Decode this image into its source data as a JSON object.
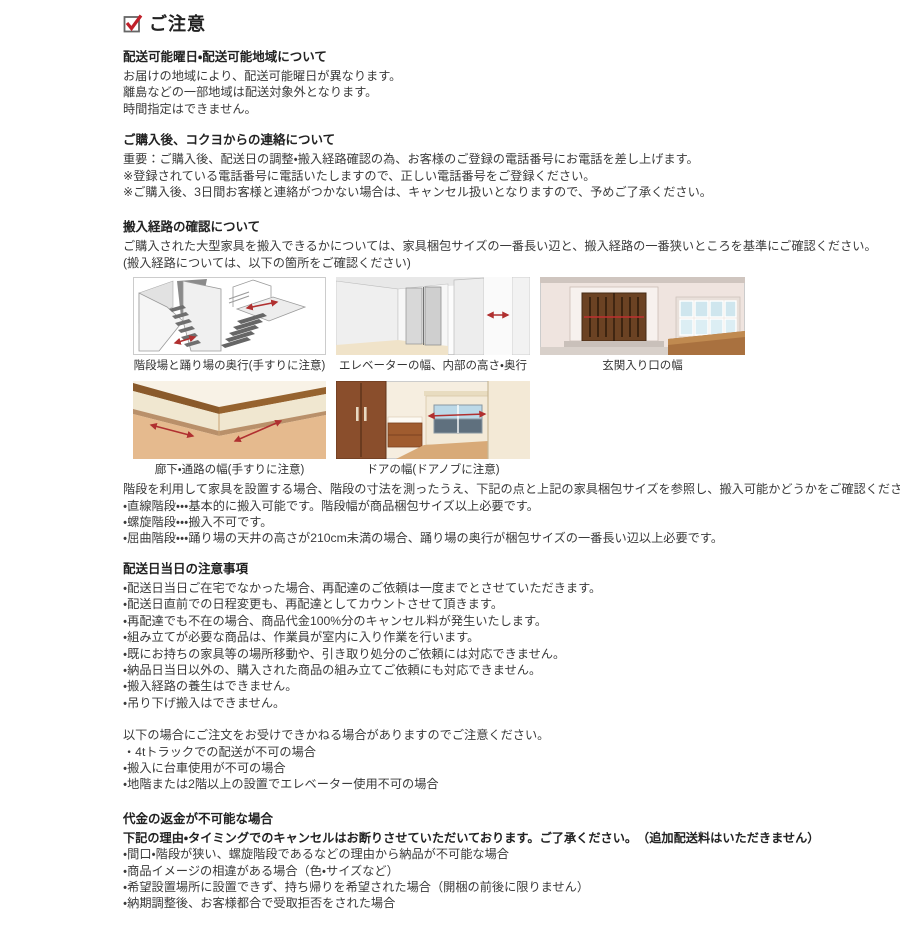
{
  "page": {
    "title": "ご注意"
  },
  "colors": {
    "accent_red": "#c0202a",
    "arrow_red": "#b03030",
    "text": "#333333"
  },
  "sections": [
    {
      "heading": "配送可能曜日・配送可能地域について",
      "lines": [
        "お届けの地域により、配送可能曜日が異なります。",
        "離島などの一部地域は配送対象外となります。",
        "時間指定はできません。"
      ]
    },
    {
      "heading": "ご購入後、コクヨからの連絡について",
      "lines": [
        "重要：ご購入後、配送日の調整・搬入経路確認の為、お客様のご登録の電話番号にお電話を差し上げます。",
        "※登録されている電話番号に電話いたしますので、正しい電話番号をご登録ください。",
        "※ご購入後、3日間お客様と連絡がつかない場合は、キャンセル扱いとなりますので、予めご了承ください。"
      ]
    },
    {
      "heading": "搬入経路の確認について",
      "lines": [
        "ご購入された大型家具を搬入できるかについては、家具梱包サイズの一番長い辺と、搬入経路の一番狭いところを基準にご確認ください。",
        "(搬入経路については、以下の箇所をご確認ください)"
      ]
    }
  ],
  "illustrations": {
    "row1": [
      {
        "caption": "階段場と踊り場の奥行(手すりに注意)"
      },
      {
        "caption": "エレベーターの幅、内部の高さ・奥行"
      },
      {
        "caption": "玄関入り口の幅"
      }
    ],
    "row2": [
      {
        "caption": "廊下・通路の幅(手すりに注意)"
      },
      {
        "caption": "ドアの幅(ドアノブに注意)"
      }
    ]
  },
  "stairs_note": {
    "intro": "階段を利用して家具を設置する場合、階段の寸法を測ったうえ、下記の点と上記の家具梱包サイズを参照し、搬入可能かどうかをご確認ください。",
    "bullets": [
      "・直線階段・・・基本的に搬入可能です。階段幅が商品梱包サイズ以上必要です。",
      "・螺旋階段・・・搬入不可です。",
      "・屈曲階段・・・踊り場の天井の高さが210cm未満の場合、踊り場の奥行が梱包サイズの一番長い辺以上必要です。"
    ]
  },
  "delivery_day": {
    "heading": "配送日当日の注意事項",
    "bullets": [
      "・配送日当日ご在宅でなかった場合、再配達のご依頼は一度までとさせていただきます。",
      "・配送日直前での日程変更も、再配達としてカウントさせて頂きます。",
      "・再配達でも不在の場合、商品代金100%分のキャンセル料が発生いたします。",
      "・組み立てが必要な商品は、作業員が室内に入り作業を行います。",
      "・既にお持ちの家具等の場所移動や、引き取り処分のご依頼には対応できません。",
      "・納品日当日以外の、購入された商品の組み立てご依頼にも対応できません。",
      "・搬入経路の養生はできません。",
      "・吊り下げ搬入はできません。"
    ]
  },
  "order_refusal": {
    "intro": "以下の場合にご注文をお受けできかねる場合がありますのでご注意ください。",
    "bullets": [
      "・4tトラックでの配送が不可の場合",
      "・搬入に台車使用が不可の場合",
      "・地階または2階以上の設置でエレベーター使用不可の場合"
    ]
  },
  "refund": {
    "heading": "代金の返金が不可能な場合",
    "intro": "下記の理由・タイミングでのキャンセルはお断りさせていただいております。ご了承ください。　（追加配送料はいただきません）",
    "bullets": [
      "・間口・階段が狭い、螺旋階段であるなどの理由から納品が不可能な場合",
      "・商品イメージの相違がある場合（色・サイズなど）",
      "・希望設置場所に設置できず、持ち帰りを希望された場合（開梱の前後に限りません）",
      "・納期調整後、お客様都合で受取拒否をされた場合"
    ]
  }
}
